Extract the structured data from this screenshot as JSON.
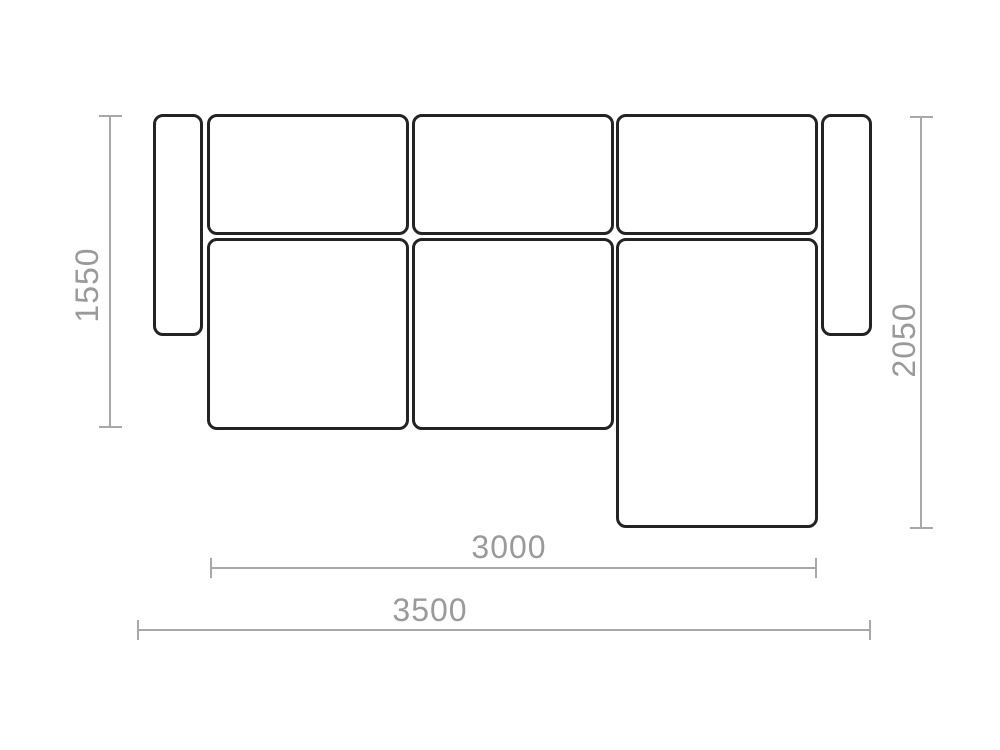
{
  "diagram": {
    "type": "sofa-floorplan-top-view",
    "dimensions": {
      "depth_left": "1550",
      "depth_right": "2050",
      "inner_width": "3000",
      "total_width": "3500"
    },
    "modules": [
      "left-armrest",
      "back-cushion-left",
      "back-cushion-middle",
      "back-cushion-right",
      "right-armrest",
      "seat-cushion-left",
      "seat-cushion-middle",
      "chaise-module"
    ],
    "colors": {
      "outline": "#232323",
      "dimension_line": "#a8a8a8",
      "dimension_text": "#9a9a9a",
      "background": "#ffffff"
    }
  }
}
